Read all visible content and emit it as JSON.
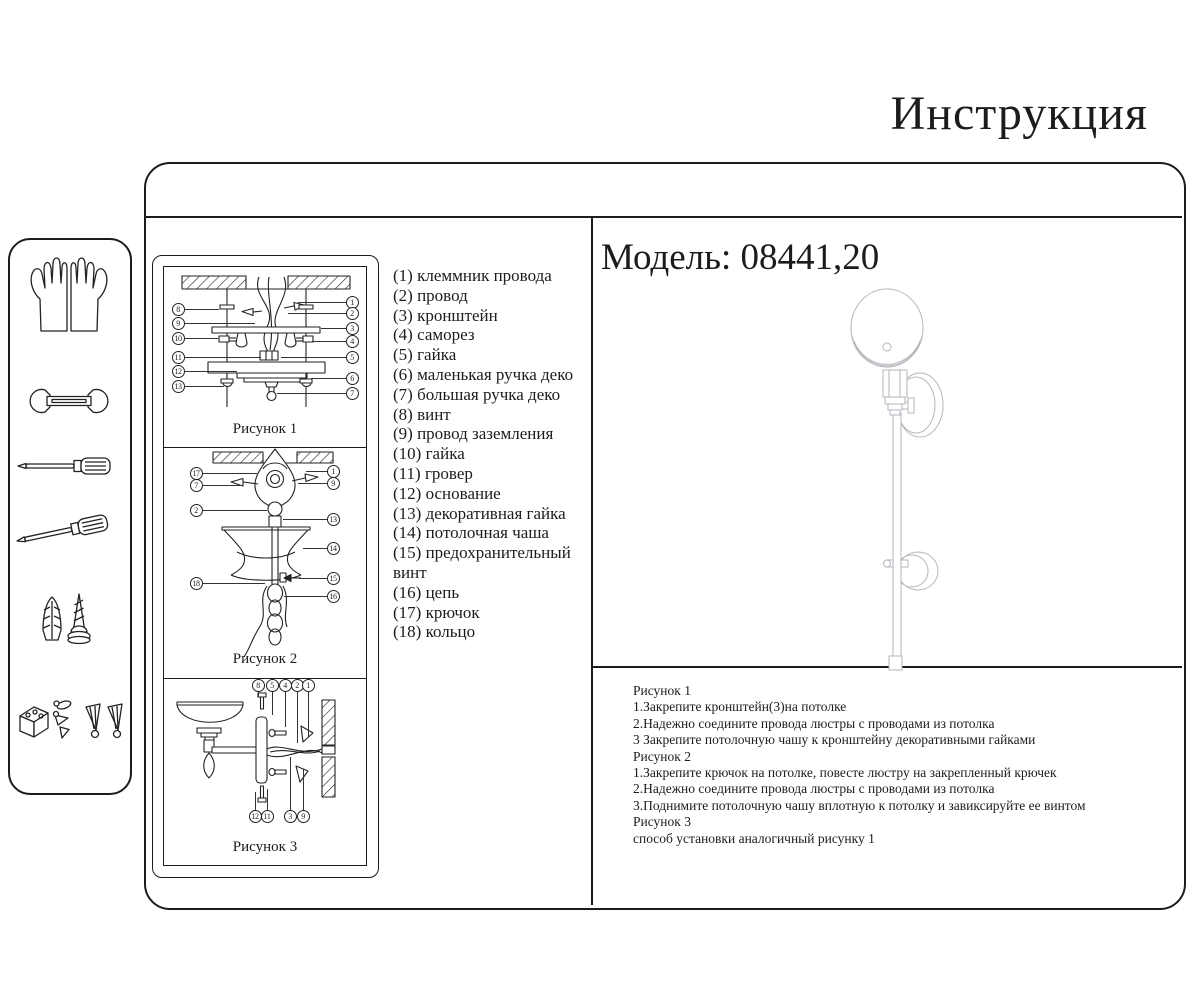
{
  "title": "Инструкция",
  "model": {
    "label": "Модель: 08441,20"
  },
  "sidebar": {
    "tools": [
      "gloves-icon",
      "wrench-icon",
      "flat-screwdriver-icon",
      "cross-screwdriver-icon",
      "dowel-screw-icon",
      "mounting-hardware-icon"
    ]
  },
  "figures": [
    {
      "caption": "Рисунок 1",
      "callouts_left": [
        "8",
        "9",
        "10",
        "11",
        "12",
        "13"
      ],
      "callouts_right": [
        "1",
        "2",
        "3",
        "4",
        "5",
        "6",
        "7"
      ]
    },
    {
      "caption": "Рисунок 2",
      "callouts_left": [
        "17",
        "7",
        "2",
        "18"
      ],
      "callouts_right": [
        "1",
        "9",
        "13",
        "14",
        "15",
        "16"
      ]
    },
    {
      "caption": "Рисунок 3",
      "callouts_top": [
        "8",
        "5",
        "4",
        "2",
        "1"
      ],
      "callouts_bottom": [
        "12",
        "11",
        "3",
        "9"
      ]
    }
  ],
  "parts_list": [
    "(1) клеммник провода",
    "(2) провод",
    "(3) кронштейн",
    "(4) саморез",
    "(5) гайка",
    "(6) маленькая ручка деко",
    "(7) большая ручка деко",
    "(8) винт",
    "(9) провод заземления",
    "(10) гайка",
    "(11) гровер",
    "(12) основание",
    "(13) декоративная гайка",
    "(14) потолочная чаша",
    "(15) предохранительный винт",
    "(16) цепь",
    "(17) крючок",
    "(18) кольцо"
  ],
  "instructions": [
    "Рисунок 1",
    "1.Закрепите кронштейн(3)на потолке",
    "2.Надежно соедините провода люстры с проводами из потолка",
    "3 Закрепите потолочную чашу к кронштейну декоративными гайками",
    "Рисунок 2",
    "1.Закрепите крючок на потолке, повесте люстру на закрепленный крючек",
    "2.Надежно соедините провода люстры с проводами из потолка",
    "3.Поднимите потолочную чашу вплотную к потолку и завиксируйте ее винтом",
    "Рисунок 3",
    "способ установки аналогичный рисунку 1"
  ],
  "colors": {
    "ink": "#1c1c1c",
    "lamp_line": "#b6b6bd"
  }
}
